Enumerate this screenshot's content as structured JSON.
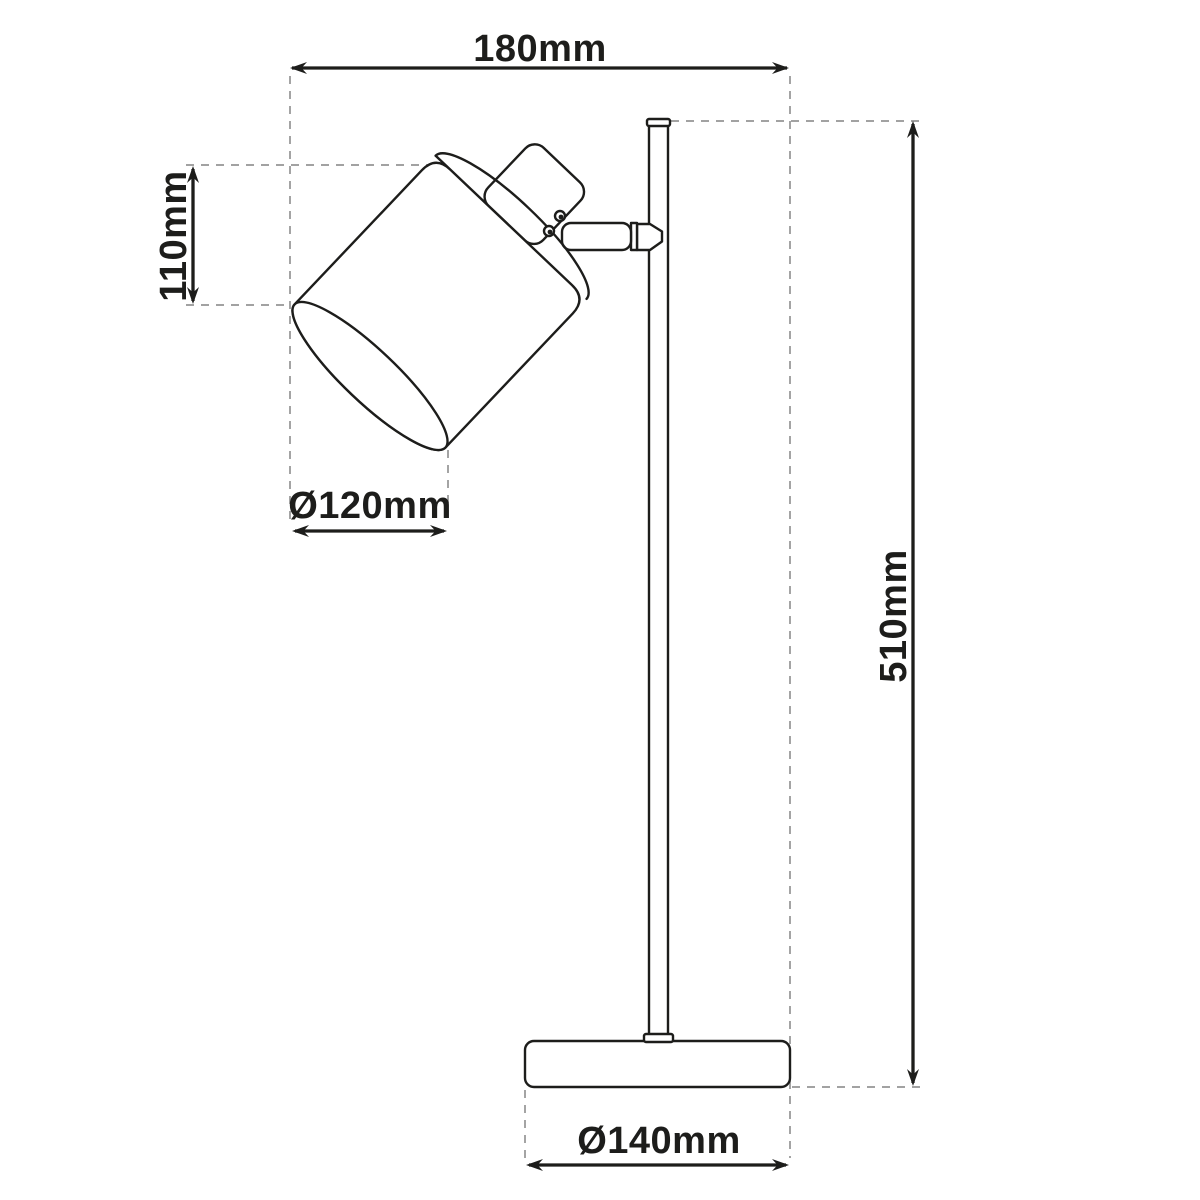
{
  "diagram": {
    "kind": "product-dimension-line-drawing",
    "colors": {
      "line": "#1d1d1b",
      "extension_line": "#959595",
      "background": "#ffffff"
    },
    "dimensions": {
      "head_width": {
        "label": "180mm"
      },
      "shade_height": {
        "label": "110mm"
      },
      "shade_diameter": {
        "label": "Ø120mm"
      },
      "total_height": {
        "label": "510mm"
      },
      "base_diameter": {
        "label": "Ø140mm"
      }
    }
  }
}
